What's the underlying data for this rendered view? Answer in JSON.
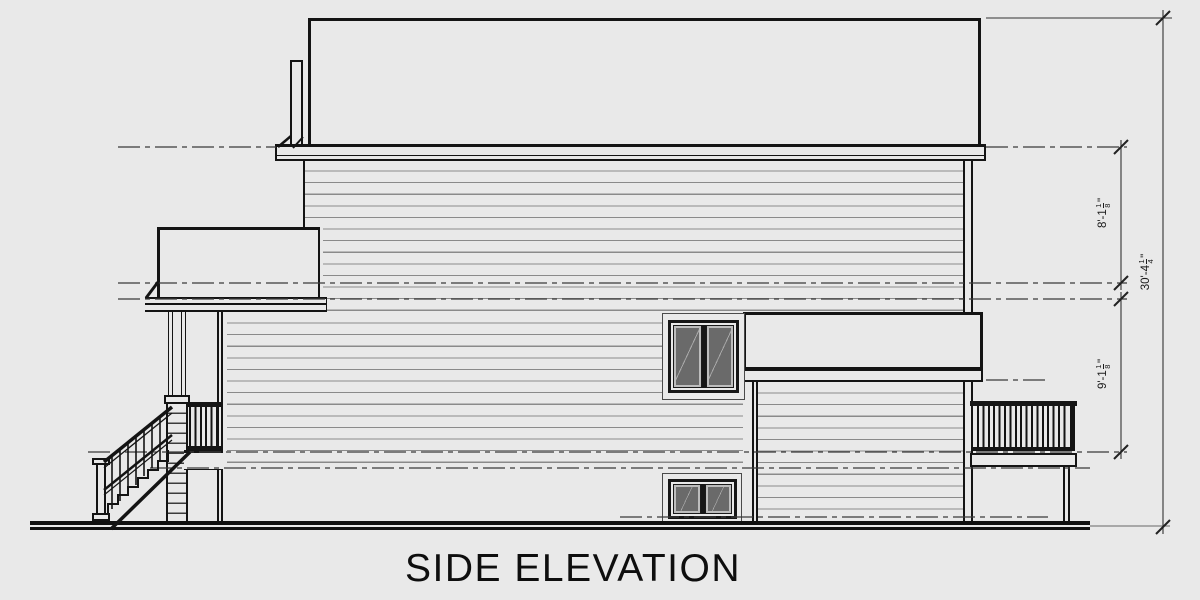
{
  "title": {
    "label": "SIDE ELEVATION"
  },
  "dimensions": {
    "upper_floor": {
      "text": "8'-1",
      "numerator": "1",
      "denominator": "8",
      "suffix": "\""
    },
    "main_floor": {
      "text": "9'-1",
      "numerator": "1",
      "denominator": "8",
      "suffix": "\""
    },
    "overall": {
      "text": "30'-4",
      "numerator": "1",
      "denominator": "4",
      "suffix": "\""
    }
  },
  "colors": {
    "background": "#e9e9e9",
    "line": "#141414",
    "siding_line": "#8a8a8a",
    "glass": "#6a6a6a",
    "level_line": "#3a3a3a"
  }
}
